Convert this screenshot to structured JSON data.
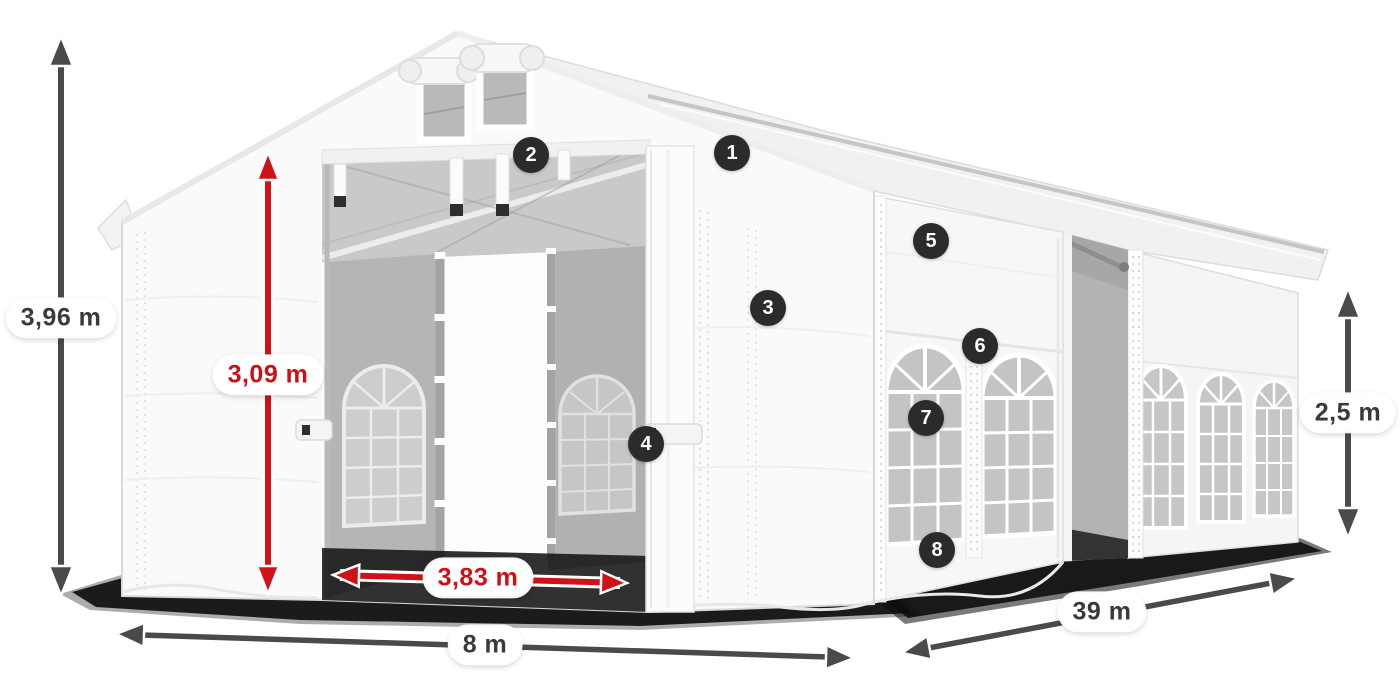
{
  "diagram": {
    "subject": "party-tent-dimension-diagram",
    "dimensions": {
      "total_height": {
        "label": "3,96 m",
        "color": "#3a3a3c"
      },
      "entrance_height": {
        "label": "3,09 m",
        "color": "#cc1016"
      },
      "entrance_width": {
        "label": "3,83 m",
        "color": "#cc1016"
      },
      "ground_width": {
        "label": "8 m",
        "color": "#3a3a3c"
      },
      "length": {
        "label": "39 m",
        "color": "#3a3a3c"
      },
      "side_height": {
        "label": "2,5 m",
        "color": "#3a3a3c"
      }
    },
    "callouts": [
      {
        "number": "1"
      },
      {
        "number": "2"
      },
      {
        "number": "3"
      },
      {
        "number": "4"
      },
      {
        "number": "5"
      },
      {
        "number": "6"
      },
      {
        "number": "7"
      },
      {
        "number": "8"
      }
    ],
    "colors": {
      "accent_red": "#d01117",
      "arrow_gray": "#4a4a4c",
      "badge_bg": "#2b2b2e",
      "badge_text": "#ffffff",
      "tent_white": "#fafafa",
      "interior_gray": "#b5b5b5"
    }
  }
}
